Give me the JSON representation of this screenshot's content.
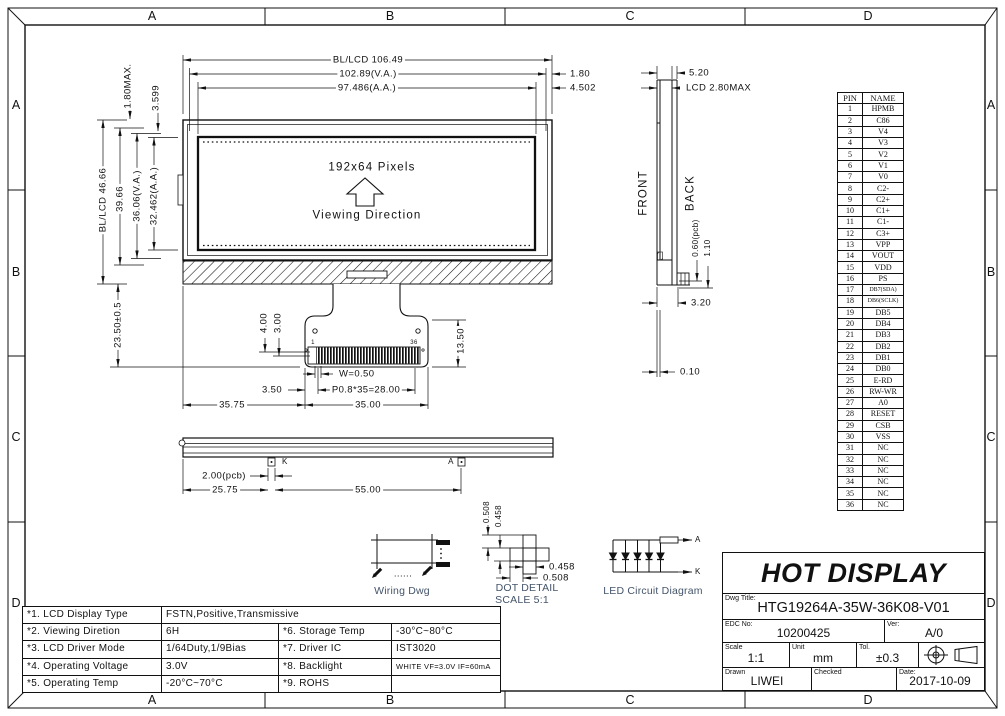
{
  "grid": {
    "letters": [
      "A",
      "B",
      "C",
      "D"
    ]
  },
  "front_view": {
    "pixels_label": "192x64 Pixels",
    "viewing_label": "Viewing Direction",
    "pin_first": "1",
    "pin_last": "36",
    "dims": {
      "width_bl": "BL/LCD 106.49",
      "width_va": "102.89(V.A.)",
      "width_aa": "97.486(A.A.)",
      "right_gap1": "1.80",
      "right_gap2": "4.502",
      "top_gap1": "1.80MAX.",
      "top_gap2": "3.599",
      "height_bl": "BL/LCD 46.66",
      "height_pcb": "39.66",
      "height_va": "36.06(V.A.)",
      "height_aa": "32.462(A.A.)",
      "tail_len": "23.50±0.5",
      "pad1": "4.00",
      "pad2": "3.00",
      "tail_depth": "13.50",
      "pad_w": "W=0.50",
      "pitch": "P0.8*35=28.00",
      "pad_off": "3.50",
      "tab_w": "35.00",
      "tab_off": "35.75"
    }
  },
  "side_view": {
    "front_label": "FRONT",
    "back_label": "BACK",
    "dims": {
      "total_t": "5.20",
      "lcd_t": "LCD 2.80MAX",
      "pcb_t": "0.60(pcb)",
      "d110": "1.10",
      "d320": "3.20",
      "d010": "0.10"
    }
  },
  "bar_view": {
    "k_label": "K",
    "a_label": "A",
    "dims": {
      "pcb2": "2.00(pcb)",
      "d2575": "25.75",
      "d5500": "55.00"
    }
  },
  "wiring": {
    "caption": "Wiring Dwg",
    "dots": "......"
  },
  "dot_detail": {
    "caption1": "DOT DETAIL",
    "caption2": "SCALE 5:1",
    "dims": {
      "v1": "0.508",
      "v2": "0.458",
      "h1": "0.458",
      "h2": "0.508"
    }
  },
  "led_circuit": {
    "caption": "LED Circuit  Diagram",
    "anode": "A",
    "cathode": "K"
  },
  "pin_table": {
    "headers": [
      "PIN",
      "NAME"
    ],
    "rows": [
      [
        "1",
        "HPMB"
      ],
      [
        "2",
        "C86"
      ],
      [
        "3",
        "V4"
      ],
      [
        "4",
        "V3"
      ],
      [
        "5",
        "V2"
      ],
      [
        "6",
        "V1"
      ],
      [
        "7",
        "V0"
      ],
      [
        "8",
        "C2-"
      ],
      [
        "9",
        "C2+"
      ],
      [
        "10",
        "C1+"
      ],
      [
        "11",
        "C1-"
      ],
      [
        "12",
        "C3+"
      ],
      [
        "13",
        "VPP"
      ],
      [
        "14",
        "VOUT"
      ],
      [
        "15",
        "VDD"
      ],
      [
        "16",
        "PS"
      ],
      [
        "17",
        "DB7(SDA)"
      ],
      [
        "18",
        "DB6(SCLK)"
      ],
      [
        "19",
        "DB5"
      ],
      [
        "20",
        "DB4"
      ],
      [
        "21",
        "DB3"
      ],
      [
        "22",
        "DB2"
      ],
      [
        "23",
        "DB1"
      ],
      [
        "24",
        "DB0"
      ],
      [
        "25",
        "E-RD"
      ],
      [
        "26",
        "RW-WR"
      ],
      [
        "27",
        "A0"
      ],
      [
        "28",
        "RESET"
      ],
      [
        "29",
        "CSB"
      ],
      [
        "30",
        "VSS"
      ],
      [
        "31",
        "NC"
      ],
      [
        "32",
        "NC"
      ],
      [
        "33",
        "NC"
      ],
      [
        "34",
        "NC"
      ],
      [
        "35",
        "NC"
      ],
      [
        "36",
        "NC"
      ]
    ]
  },
  "title_block": {
    "company": "HOT DISPLAY",
    "dwg_title_label": "Dwg Title:",
    "dwg_title": "HTG19264A-35W-36K08-V01",
    "edc_label": "EDC No:",
    "edc_no": "10200425",
    "ver_label": "Ver:",
    "ver": "A/0",
    "scale_label": "Scale",
    "scale": "1:1",
    "unit_label": "Unit",
    "unit": "mm",
    "tol_label": "Tol.",
    "tol": "±0.3",
    "drawn_label": "Drawn",
    "drawn": "LIWEI",
    "checked_label": "Checked",
    "checked": "",
    "date_label": "Date:",
    "date": "2017-10-09"
  },
  "spec_table": {
    "r1_label": "*1. LCD Display Type",
    "r1_value": "FSTN,Positive,Transmissive",
    "r2_label": "*2. Viewing Diretion",
    "r2_value": "6H",
    "r2_label2": "*6. Storage Temp",
    "r2_value2": "-30°C~80°C",
    "r3_label": "*3. LCD Driver Mode",
    "r3_value": "1/64Duty,1/9Bias",
    "r3_label2": "*7. Driver IC",
    "r3_value2": "IST3020",
    "r4_label": "*4. Operating Voltage",
    "r4_value": "3.0V",
    "r4_label2": "*8. Backlight",
    "r4_value2": "WHITE VF=3.0V IF=60mA",
    "r5_label": "*5. Operating Temp",
    "r5_value": "-20°C~70°C",
    "r5_label2": "*9. ROHS",
    "r5_value2": ""
  },
  "colors": {
    "line": "#111111",
    "caption": "#44546a",
    "paper": "#ffffff"
  }
}
